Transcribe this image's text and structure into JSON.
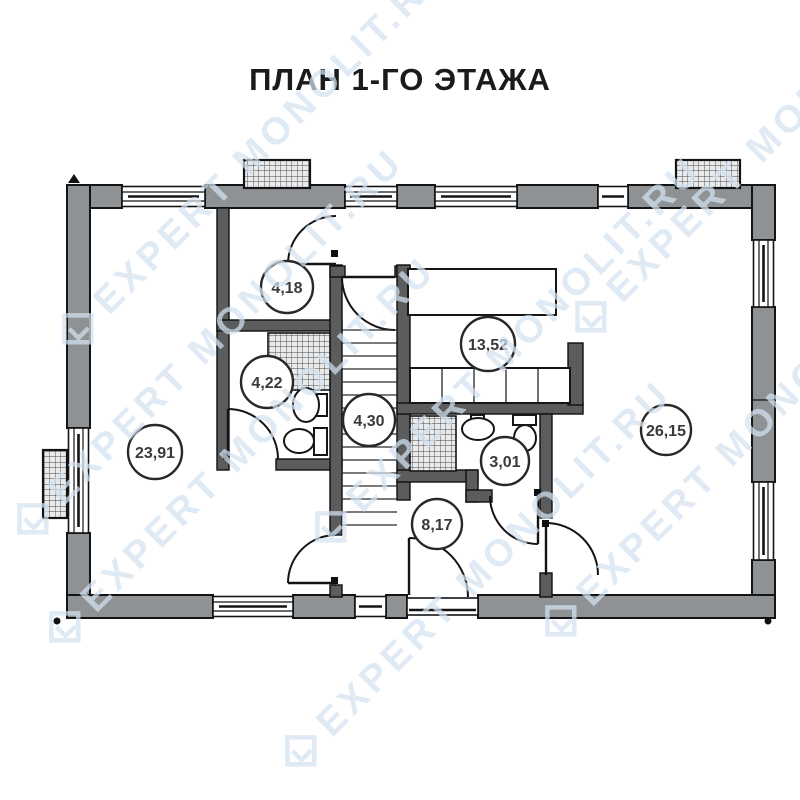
{
  "title": "ПЛАН 1-ГО ЭТАЖА",
  "watermark": {
    "text": "EXPERT MONOLIT.RU"
  },
  "rooms": [
    {
      "name": "entry-hall",
      "area": "4,18"
    },
    {
      "name": "bathroom-small",
      "area": "4,22"
    },
    {
      "name": "stair-hall",
      "area": "4,30"
    },
    {
      "name": "kitchen",
      "area": "13,52"
    },
    {
      "name": "bathroom",
      "area": "3,01"
    },
    {
      "name": "hallway",
      "area": "8,17"
    },
    {
      "name": "room-left",
      "area": "23,91"
    },
    {
      "name": "living-room",
      "area": "26,15"
    }
  ]
}
